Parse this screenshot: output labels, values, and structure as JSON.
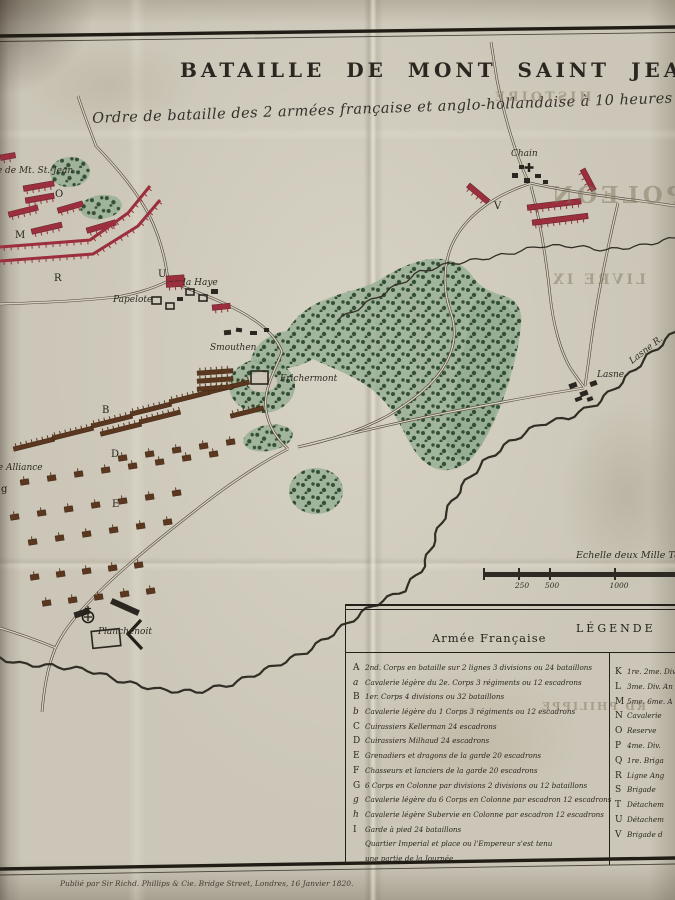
{
  "colors": {
    "paper": "#cbc6b7",
    "ink": "#2d2821",
    "red": "#9b2f3d",
    "brown": "#5a371e",
    "forest": "#93ad92",
    "tree": "#2e4a30"
  },
  "page": {
    "title": "BATAILLE DE MONT SAINT JEAN.",
    "subtitle": "Ordre de bataille des 2 armées française et anglo-hollandaise à 10 heures du m",
    "imprint": "Publié par Sir Richd. Phillips & Cie. Bridge Street, Londres, 16 Janvier 1820."
  },
  "ghost_text": [
    {
      "t": "HISTOIRE",
      "x": 492,
      "y": 90,
      "fs": 13,
      "ls": 3
    },
    {
      "t": "NAPOLEON",
      "x": 548,
      "y": 182,
      "fs": 23,
      "ls": 4
    },
    {
      "t": "LIVRE IX",
      "x": 550,
      "y": 272,
      "fs": 14,
      "ls": 3
    },
    {
      "t": "RD PHILIPPE",
      "x": 540,
      "y": 700,
      "fs": 11,
      "ls": 2
    }
  ],
  "scale_bar": {
    "label": "Echelle deux Mille Toi",
    "nums": [
      {
        "label": "250",
        "x": 39
      },
      {
        "label": "500",
        "x": 69
      },
      {
        "label": "1000",
        "x": 136
      }
    ],
    "tick_x": [
      0,
      35,
      66,
      131
    ]
  },
  "legend": {
    "header": "LÉGENDE",
    "french_header": "Armée Française",
    "french_rows": [
      {
        "key": "A",
        "text": "2nd. Corps en bataille sur 2 lignes 3 divisions ou 24 bataillons"
      },
      {
        "key": "a",
        "text": "Cavalerie légère du 2e. Corps 3 régiments ou 12 escadrons"
      },
      {
        "key": "B",
        "text": "1er. Corps 4 divisions ou 32 bataillons"
      },
      {
        "key": "b",
        "text": "Cavalerie légère du 1 Corps 3 régiments ou 12 escadrons"
      },
      {
        "key": "C",
        "text": "Cuirassiers Kellerman 24 escadrons"
      },
      {
        "key": "D",
        "text": "Cuirassiers Milhaud 24 escadrons"
      },
      {
        "key": "E",
        "text": "Grenadiers et dragons de la garde 20 escadrons"
      },
      {
        "key": "F",
        "text": "Chasseurs et lanciers de la garde 20 escadrons"
      },
      {
        "key": "G",
        "text": "6 Corps en Colonne par divisions 2 divisions ou 12 bataillons"
      },
      {
        "key": "g",
        "text": "Cavalerie légère du 6 Corps en Colonne par escadron 12 escadrons"
      },
      {
        "key": "h",
        "text": "Cavalerie légère Subervie en Colonne par escadron 12 escadrons"
      },
      {
        "key": "I",
        "text": "Garde à pied 24 bataillons"
      },
      {
        "key": "",
        "text": "Quartier Imperial et place ou l'Empereur s'est tenu"
      },
      {
        "key": "",
        "text": "une partie de la Journée"
      }
    ],
    "allied_rows": [
      {
        "key": "K",
        "text": "1re. 2me. Div"
      },
      {
        "key": "L",
        "text": "3me. Div. An"
      },
      {
        "key": "M",
        "text": "5me. 6me. A"
      },
      {
        "key": "N",
        "text": "Cavalerie"
      },
      {
        "key": "O",
        "text": "Reserve"
      },
      {
        "key": "P",
        "text": "4me. Div."
      },
      {
        "key": "Q",
        "text": "1re. Briga"
      },
      {
        "key": "R",
        "text": "Ligne Ang"
      },
      {
        "key": "S",
        "text": "Brigade"
      },
      {
        "key": "T",
        "text": "Détachem"
      },
      {
        "key": "U",
        "text": "Détachem"
      },
      {
        "key": "V",
        "text": "Brigade d"
      }
    ]
  },
  "map": {
    "labels": [
      {
        "t": "rme de Mt. St. Jean",
        "x": -16,
        "y": 173,
        "fs": 9
      },
      {
        "t": "la Haye",
        "x": 183,
        "y": 285,
        "fs": 9
      },
      {
        "t": "Papelote",
        "x": 113,
        "y": 302,
        "fs": 9
      },
      {
        "t": "Smouthen",
        "x": 210,
        "y": 350,
        "fs": 9
      },
      {
        "t": "Frichermont",
        "x": 280,
        "y": 381,
        "fs": 9
      },
      {
        "t": "Chain",
        "x": 511,
        "y": 156,
        "fs": 9
      },
      {
        "t": "Lasne",
        "x": 597,
        "y": 377,
        "fs": 9
      },
      {
        "t": "Lasne R.",
        "x": 632,
        "y": 364,
        "fs": 9,
        "rot": -38
      },
      {
        "t": "Planchenoit",
        "x": 98,
        "y": 634,
        "fs": 9
      },
      {
        "t": "lle Alliance",
        "x": -8,
        "y": 470,
        "fs": 9
      }
    ],
    "letters": [
      {
        "t": "O",
        "x": 55,
        "y": 197
      },
      {
        "t": "M",
        "x": 15,
        "y": 238
      },
      {
        "t": "R",
        "x": 54,
        "y": 281
      },
      {
        "t": "U",
        "x": 158,
        "y": 277
      },
      {
        "t": "V",
        "x": 494,
        "y": 209
      },
      {
        "t": "B",
        "x": 102,
        "y": 413
      },
      {
        "t": "D",
        "x": 111,
        "y": 457
      },
      {
        "t": "E",
        "x": 112,
        "y": 507
      },
      {
        "t": "g",
        "x": 1,
        "y": 492
      }
    ],
    "roads": [
      "M78 96 C85 118 91 132 96 146 C119 170 139 194 151 219 C161 241 166 261 168 281",
      "M168 281 C150 290 133 294 117 297 C88 300 56 302 28 303 L0 304",
      "M168 281 C200 293 230 304 251 318 C267 328 277 339 282 352",
      "M282 352 C276 368 268 381 266 397 C264 415 271 433 288 449",
      "M288 449 C262 462 226 486 196 510 C160 538 120 570 93 598 C77 614 63 631 55 649 C47 669 44 690 42 712",
      "M0 628 C20 634 39 641 56 648",
      "M529 184 C492 196 463 218 451 247 C443 268 443 291 451 313 C459 336 452 360 433 381 C420 395 404 406 389 415 C362 430 332 440 298 447",
      "M298 447 C341 436 391 424 440 414 C476 407 513 400 547 394 C560 392 572 390 584 388",
      "M531 186 C540 220 546 257 550 295 C553 323 560 351 571 369 C576 376 580 382 584 387",
      "M530 183 C560 190 601 196 641 201 L675 206",
      "M528 181 C516 155 505 119 497 80 L491 42",
      "M618 203 C607 250 597 299 591 343 C589 359 587 373 585 386"
    ],
    "rivers": [
      {
        "w": 2.2,
        "amp": 2.2,
        "pts": [
          [
            675,
            332
          ],
          [
            648,
            356
          ],
          [
            622,
            382
          ],
          [
            596,
            404
          ],
          [
            568,
            418
          ],
          [
            540,
            424
          ],
          [
            510,
            442
          ],
          [
            484,
            462
          ],
          [
            462,
            486
          ],
          [
            446,
            512
          ],
          [
            434,
            540
          ],
          [
            424,
            566
          ],
          [
            404,
            590
          ],
          [
            372,
            606
          ],
          [
            338,
            630
          ],
          [
            306,
            652
          ],
          [
            270,
            668
          ],
          [
            232,
            684
          ],
          [
            196,
            692
          ],
          [
            160,
            690
          ],
          [
            124,
            682
          ],
          [
            88,
            670
          ],
          [
            52,
            666
          ],
          [
            20,
            664
          ],
          [
            0,
            658
          ]
        ]
      },
      {
        "w": 1.3,
        "amp": 1.8,
        "pts": [
          [
            675,
            238
          ],
          [
            640,
            246
          ],
          [
            606,
            250
          ],
          [
            572,
            246
          ],
          [
            540,
            246
          ],
          [
            508,
            254
          ],
          [
            476,
            260
          ],
          [
            448,
            264
          ],
          [
            420,
            272
          ],
          [
            396,
            286
          ],
          [
            372,
            300
          ],
          [
            352,
            312
          ],
          [
            338,
            320
          ]
        ]
      }
    ],
    "forests": [
      {
        "d": "M252 356 C257 342 271 333 287 331 C295 317 309 305 327 299 C345 291 365 289 381 279 C397 269 413 261 431 259 C451 257 465 265 473 277 C481 289 495 293 507 297 C517 301 523 311 521 325 C519 345 514 367 506 391 C498 415 488 437 476 453 C466 467 451 473 437 469 C422 464 412 449 404 432 C394 412 382 395 364 384 C348 373 329 367 313 359 C299 367 283 371 269 367 C257 363 248 362 252 356 Z"
      },
      {
        "d": "M476 302 C490 296 506 300 512 314 C518 328 514 352 508 376 C501 400 492 424 482 444 C474 458 462 464 452 456 C444 448 446 432 450 414 C456 388 462 356 468 330 C471 316 468 308 476 302 Z"
      },
      {
        "e": [
          262,
          386,
          33,
          27,
          0
        ]
      },
      {
        "e": [
          268,
          438,
          25,
          13,
          -10
        ]
      },
      {
        "e": [
          316,
          491,
          27,
          23,
          0
        ]
      },
      {
        "e": [
          70,
          172,
          20,
          15,
          -5
        ]
      },
      {
        "e": [
          101,
          207,
          21,
          12,
          -8
        ]
      }
    ],
    "clearings": [
      [
        262,
        382,
        15,
        10
      ]
    ],
    "allied_bars": [
      [
        23,
        186,
        31,
        -10
      ],
      [
        25,
        198,
        29,
        -10
      ],
      [
        8,
        212,
        30,
        -14
      ],
      [
        57,
        208,
        26,
        -16
      ],
      [
        31,
        229,
        31,
        -13
      ],
      [
        86,
        228,
        30,
        -16
      ],
      [
        0,
        155,
        15,
        -10
      ],
      [
        166,
        276,
        18,
        -4
      ],
      [
        166,
        282,
        18,
        -4
      ],
      [
        212,
        305,
        18,
        -6
      ],
      [
        527,
        205,
        54,
        -7
      ],
      [
        532,
        220,
        56,
        -7
      ],
      [
        470,
        183,
        26,
        40
      ],
      [
        585,
        168,
        24,
        62
      ]
    ],
    "allied_lines": [
      {
        "pts": [
          [
            0,
            247
          ],
          [
            90,
            240
          ],
          [
            128,
            213
          ],
          [
            150,
            186
          ]
        ]
      },
      {
        "pts": [
          [
            0,
            261
          ],
          [
            93,
            254
          ],
          [
            138,
            226
          ],
          [
            160,
            200
          ]
        ]
      }
    ],
    "french_bars": [
      [
        13,
        447
      ],
      [
        52,
        436
      ],
      [
        91,
        424
      ],
      [
        130,
        412
      ],
      [
        169,
        400
      ],
      [
        208,
        390
      ],
      [
        100,
        432
      ],
      [
        139,
        420
      ],
      [
        230,
        414,
        34,
        -14
      ],
      [
        197,
        371,
        36,
        -4
      ],
      [
        197,
        379,
        36,
        -4
      ],
      [
        197,
        387,
        36,
        -4
      ]
    ],
    "french_sq": [
      [
        118,
        456
      ],
      [
        145,
        452
      ],
      [
        172,
        448
      ],
      [
        199,
        444
      ],
      [
        226,
        440
      ],
      [
        20,
        480
      ],
      [
        47,
        476
      ],
      [
        74,
        472
      ],
      [
        101,
        468
      ],
      [
        128,
        464
      ],
      [
        155,
        460
      ],
      [
        182,
        456
      ],
      [
        209,
        452
      ],
      [
        10,
        515
      ],
      [
        37,
        511
      ],
      [
        64,
        507
      ],
      [
        91,
        503
      ],
      [
        118,
        499
      ],
      [
        145,
        495
      ],
      [
        172,
        491
      ],
      [
        28,
        540
      ],
      [
        55,
        536
      ],
      [
        82,
        532
      ],
      [
        109,
        528
      ],
      [
        136,
        524
      ],
      [
        163,
        520
      ],
      [
        30,
        575
      ],
      [
        56,
        572
      ],
      [
        82,
        569
      ],
      [
        108,
        566
      ],
      [
        134,
        563
      ],
      [
        42,
        601
      ],
      [
        68,
        598
      ],
      [
        94,
        595
      ],
      [
        120,
        592
      ],
      [
        146,
        589
      ]
    ],
    "buildings": [
      [
        224,
        330,
        7,
        5,
        -5,
        0
      ],
      [
        236,
        328,
        6,
        4,
        8,
        0
      ],
      [
        250,
        331,
        7,
        4,
        0,
        0
      ],
      [
        264,
        328,
        5,
        4,
        0,
        0
      ],
      [
        186,
        289,
        8,
        6,
        0,
        1
      ],
      [
        199,
        295,
        8,
        6,
        0,
        1
      ],
      [
        211,
        289,
        7,
        5,
        0,
        0
      ],
      [
        177,
        297,
        6,
        4,
        0,
        0
      ],
      [
        152,
        297,
        9,
        7,
        0,
        1
      ],
      [
        166,
        303,
        8,
        6,
        0,
        1
      ],
      [
        512,
        173,
        6,
        5,
        0,
        0
      ],
      [
        524,
        178,
        6,
        5,
        0,
        0
      ],
      [
        535,
        174,
        6,
        4,
        0,
        0
      ],
      [
        519,
        165,
        5,
        4,
        0,
        0
      ],
      [
        543,
        180,
        5,
        4,
        0,
        0
      ],
      [
        569,
        383,
        8,
        5,
        -20,
        0
      ],
      [
        580,
        391,
        8,
        5,
        -20,
        0
      ],
      [
        590,
        381,
        7,
        5,
        -20,
        0
      ],
      [
        575,
        397,
        7,
        4,
        -20,
        0
      ],
      [
        587,
        397,
        6,
        4,
        -20,
        0
      ],
      [
        251,
        371,
        17,
        13,
        0,
        1
      ],
      [
        110,
        604,
        30,
        6,
        24,
        0
      ],
      [
        92,
        630,
        28,
        17,
        -6,
        1
      ],
      [
        74,
        610,
        16,
        6,
        -18,
        0
      ]
    ]
  }
}
